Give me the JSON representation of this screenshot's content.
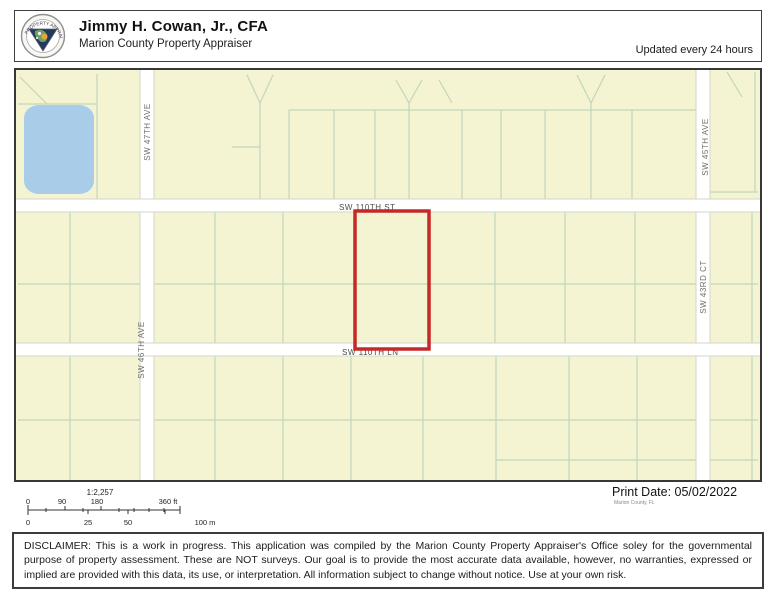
{
  "header": {
    "title": "Jimmy H. Cowan, Jr., CFA",
    "subtitle": "Marion County Property Appraiser",
    "updated": "Updated every 24 hours",
    "logo_ring_text": "PROPERTY APPRAISER"
  },
  "map": {
    "streets": {
      "sw47ave": "SW 47TH AVE",
      "sw46ave": "SW 46TH AVE",
      "sw45ave": "SW 45TH AVE",
      "sw43ct": "SW 43RD CT",
      "sw110st": "SW 110TH ST",
      "sw110ln": "SW 110TH LN"
    },
    "colors": {
      "parcel_fill": "#f4f4d2",
      "parcel_line": "#c3d5bd",
      "road_fill": "#ffffff",
      "water_fill": "#a9cde9",
      "highlight_stroke": "#c62828"
    }
  },
  "footer": {
    "scale_ratio": "1:2,257",
    "ft_labels": [
      "0",
      "90",
      "180",
      "360 ft"
    ],
    "m_labels": [
      "0",
      "25",
      "50",
      "100 m"
    ],
    "print_date": "Print Date: 05/02/2022",
    "print_source": "Marion County, FL"
  },
  "disclaimer": "DISCLAIMER: This is a work in progress. This application was compiled by the Marion County Property Appraiser's Office soley for the governmental purpose of property assessment. These are NOT surveys. Our goal is to provide the most accurate data available, however, no warranties, expressed or implied are provided with this data, its use, or interpretation. All information subject to change without notice. Use at your own risk."
}
